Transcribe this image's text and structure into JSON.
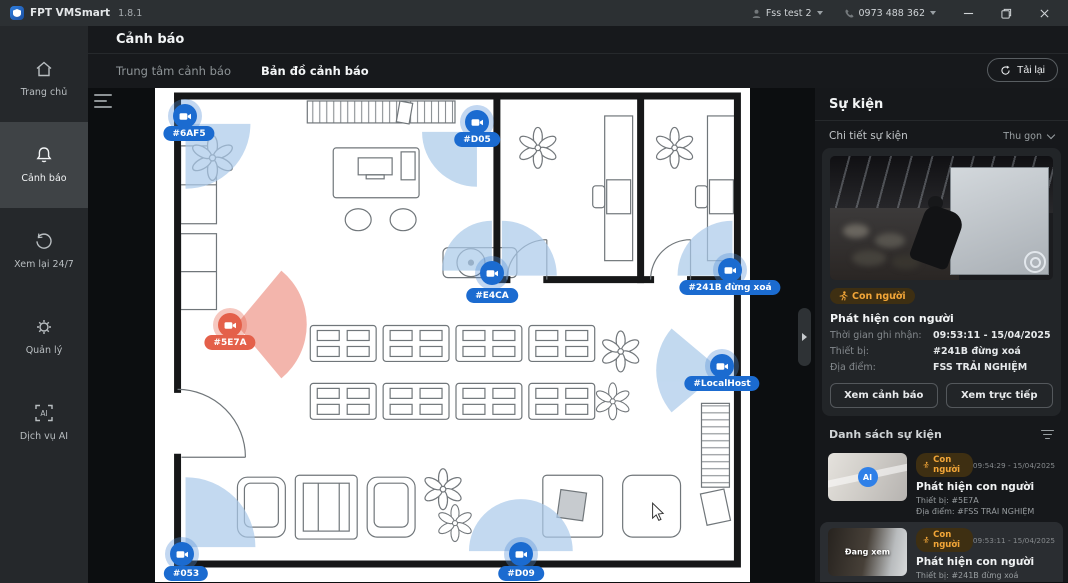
{
  "titlebar": {
    "app_name": "FPT VMSmart",
    "version": "1.8.1",
    "account_label": "Fss test 2",
    "phone_label": "0973 488 362"
  },
  "sidebar": {
    "items": [
      {
        "id": "home",
        "label": "Trang chủ"
      },
      {
        "id": "alerts",
        "label": "Cảnh báo"
      },
      {
        "id": "playback",
        "label": "Xem lại 24/7"
      },
      {
        "id": "manage",
        "label": "Quản lý"
      },
      {
        "id": "ai",
        "label": "Dịch vụ AI"
      }
    ]
  },
  "header": {
    "title": "Cảnh báo",
    "tab_center": "Trung tâm cảnh báo",
    "tab_map": "Bản đồ cảnh báo",
    "reload_label": "Tải lại"
  },
  "map": {
    "cameras": [
      {
        "label": "#6AF5",
        "status": "normal"
      },
      {
        "label": "#D05",
        "status": "normal"
      },
      {
        "label": "#E4CA",
        "status": "normal"
      },
      {
        "label": "#241B đừng xoá",
        "status": "normal"
      },
      {
        "label": "#5E7A",
        "status": "alert"
      },
      {
        "label": "#LocalHost",
        "status": "normal"
      },
      {
        "label": "#053",
        "status": "normal"
      },
      {
        "label": "#D09",
        "status": "normal"
      }
    ],
    "colors": {
      "camera_normal": "#1b6bd0",
      "camera_alert": "#e4604a",
      "fov_normal": "#a9c9e9",
      "fov_alert": "#f1a89d"
    }
  },
  "events_panel": {
    "title": "Sự kiện",
    "detail_header": "Chi tiết sự kiện",
    "collapse_label": "Thu gọn",
    "detail": {
      "badge_label": "Con người",
      "event_name": "Phát hiện con người",
      "time_label": "Thời gian ghi nhận:",
      "time_value": "09:53:11 - 15/04/2025",
      "device_label": "Thiết bị:",
      "device_value": "#241B đừng xoá",
      "location_label": "Địa điểm:",
      "location_value": "FSS TRẢI NGHIỆM",
      "btn_view_alert": "Xem cảnh báo",
      "btn_view_live": "Xem trực tiếp"
    },
    "list_header": "Danh sách sự kiện",
    "list": [
      {
        "badge_label": "Con người",
        "time": "09:54:29 - 15/04/2025",
        "name": "Phát hiện con người",
        "device": "Thiết bị: #5E7A",
        "location": "Địa điểm: #FSS TRẢI NGHIỆM",
        "thumb_overlay": "AI"
      },
      {
        "badge_label": "Con người",
        "time": "09:53:11 - 15/04/2025",
        "name": "Phát hiện con người",
        "device": "Thiết bị: #241B đừng xoá",
        "location": "Địa điểm: #FSS TRẢI NGHIỆM",
        "thumb_overlay": "Đang xem"
      }
    ]
  }
}
